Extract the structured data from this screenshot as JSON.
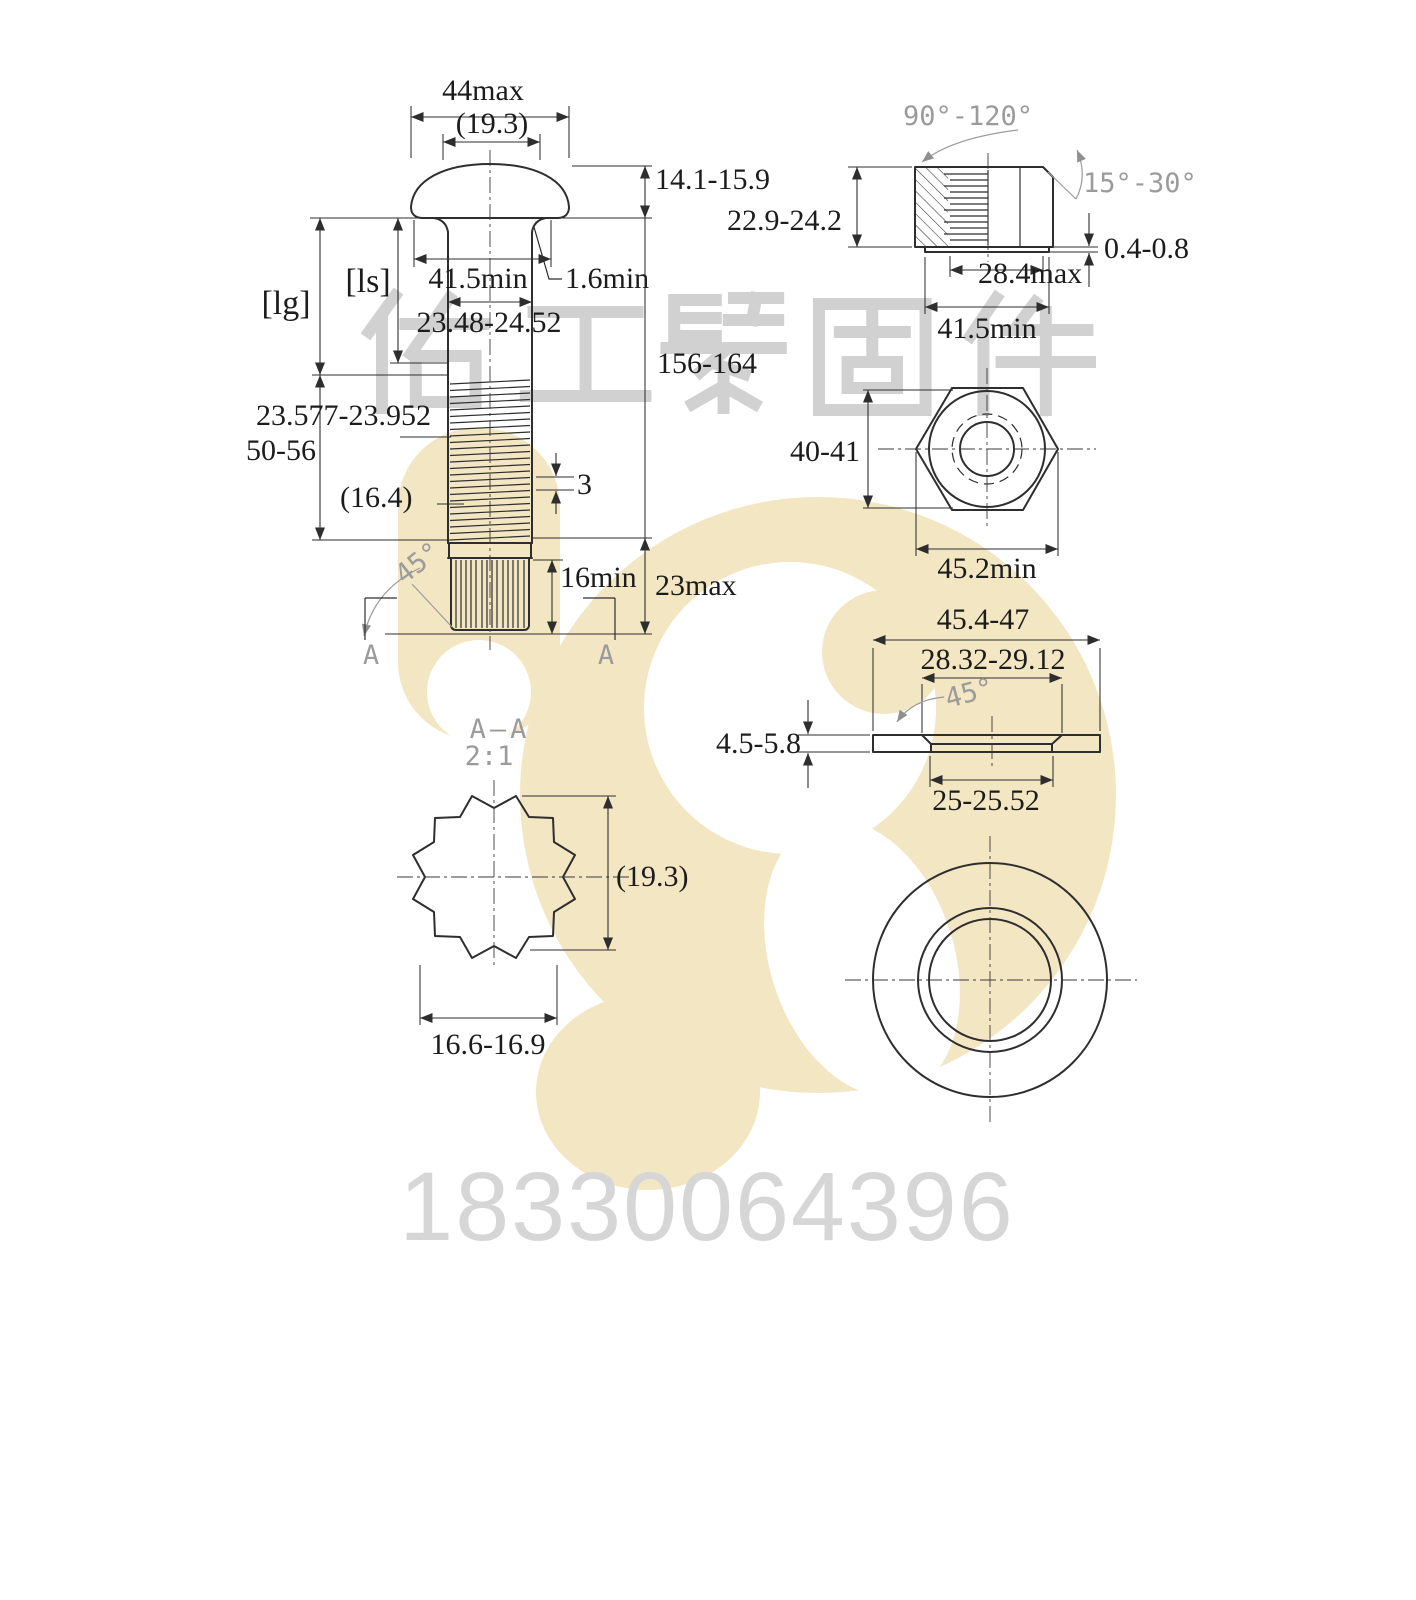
{
  "title": "Fastener technical drawing (track bolt, nut, flat washer)",
  "colors": {
    "line": "#2e2e2e",
    "dim_text": "#1c1c1c",
    "cad_gray": "#9b9b9b",
    "logo_yellow": "#f3e6c3",
    "watermark_gray": "#c9c9c9",
    "phone_gray": "#d6d6d6"
  },
  "bolt_front": {
    "dim_44max": "44max",
    "dim_head_ref": "(19.3)",
    "dim_head_height": "14.1-15.9",
    "dim_bearing": "41.5min",
    "dim_fillet": "1.6min",
    "dim_shank": "23.48-24.52",
    "lbl_lg": "[lg]",
    "lbl_ls": "[ls]",
    "dim_thread": "23.577-23.952",
    "dim_thread_len": "50-56",
    "dim_ref": "(16.4)",
    "dim_pitch": "3",
    "dim_overall": "156-164",
    "dim_tip": "23max",
    "dim_spline": "16min",
    "ang_chamfer": "45°",
    "section_letter": "A"
  },
  "nut_side": {
    "ang_countersink": "90°-120°",
    "ang_chamfer": "15°-30°",
    "dim_height": "22.9-24.2",
    "dim_washer_face_t": "0.4-0.8",
    "dim_washer_face_d": "28.4max",
    "dim_bearing": "41.5min"
  },
  "nut_top": {
    "dim_across_flats": "40-41",
    "dim_across_corners": "45.2min"
  },
  "washer_side": {
    "dim_od": "45.4-47",
    "dim_chamfer_d": "28.32-29.12",
    "ang_chamfer": "45°",
    "dim_thickness": "4.5-5.8",
    "dim_id": "25-25.52"
  },
  "section_aa": {
    "title": "A—A",
    "scale": "2:1",
    "dim_ref": "(19.3)",
    "dim_width": "16.6-16.9"
  },
  "watermark": {
    "company": "佑工紧固件",
    "phone": "18330064396"
  }
}
